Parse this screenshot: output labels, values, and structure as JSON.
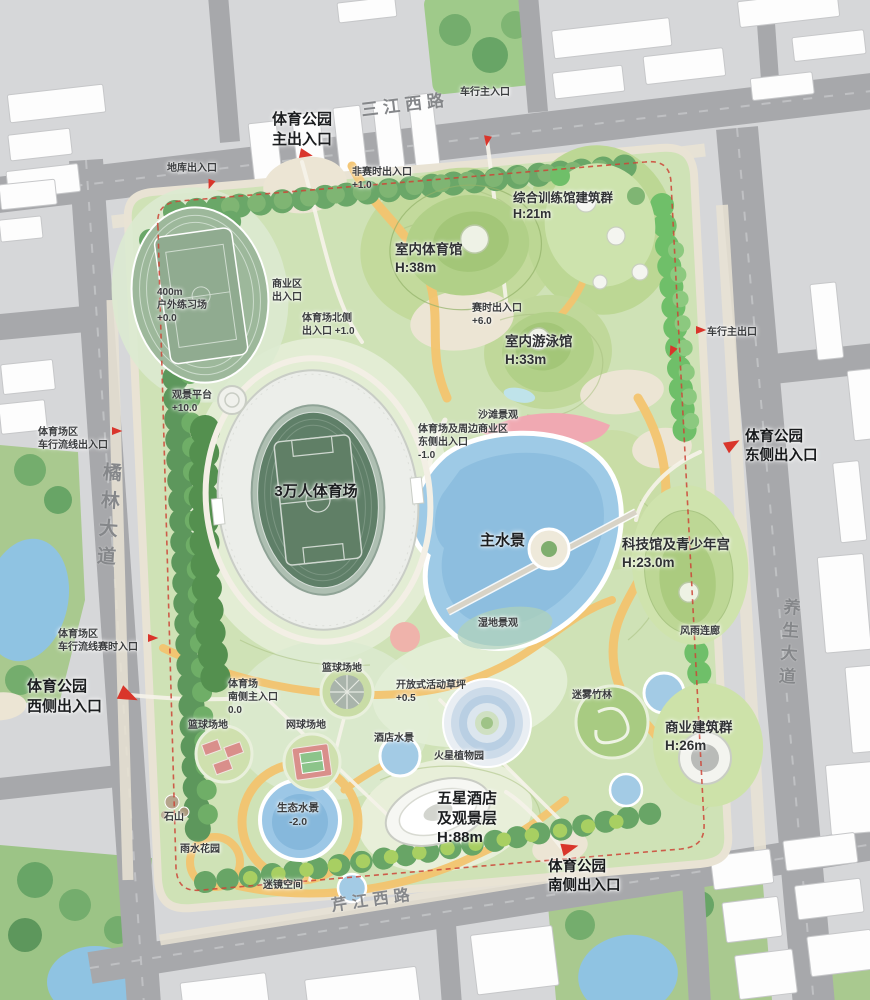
{
  "roads": {
    "top": "三江西路",
    "left": "橘林大道",
    "right": "养生大道",
    "bottom": "芹江西路"
  },
  "gates": {
    "main": "体育公园\n主出入口",
    "east": "体育公园\n东侧出入口",
    "west": "体育公园\n西侧出入口",
    "south": "体育公园\n南侧出入口"
  },
  "vehicle_access": {
    "car_main_in": "车行主入口",
    "car_main_out": "车行主出口",
    "garage": "地库出入口",
    "west_flow": "体育场区\n车行流线出入口",
    "west_flow_event": "体育场区\n车行流线赛时入口"
  },
  "park_entries": {
    "non_event": "非赛时出入口\n+1.0",
    "event": "赛时出入口\n+6.0",
    "business": "商业区\n出入口",
    "stadium_north": "体育场北侧\n出入口 +1.0",
    "stadium_south": "体育场\n南侧主入口\n0.0",
    "stadium_biz_east": "体育场及周边商业区\n东侧出入口\n-1.0"
  },
  "facilities": {
    "training": "综合训练馆建筑群\nH:21m",
    "indoor_gym": "室内体育馆\nH:38m",
    "pool": "室内游泳馆\nH:33m",
    "stadium": "3万人体育场",
    "track400": "400m\n户外练习场\n+0.0",
    "tech": "科技馆及青少年宫\nH:23.0m",
    "commerce": "商业建筑群\nH:26m",
    "hotel": "五星酒店\n及观景层\nH:88m"
  },
  "landscape": {
    "view_platform": "观景平台\n+10.0",
    "beach": "沙滩景观",
    "main_water": "主水景",
    "wetland": "湿地景观",
    "corridor": "风雨连廊",
    "bamboo": "迷雾竹林",
    "lawn": "开放式活动草坪\n+0.5",
    "basketball_upper": "篮球场地",
    "basketball_lower": "篮球场地",
    "tennis": "网球场地",
    "hotel_water": "酒店水景",
    "mars_garden": "火星植物园",
    "rock": "石山",
    "eco_water": "生态水景\n-2.0",
    "rain_garden": "雨水花园",
    "mirror_space": "迷镜空间"
  },
  "icons": {
    "entrance_flag": "red-flag-arrow"
  },
  "colors": {
    "accent_red": "#d23b2f",
    "boundary_red": "#cc4436",
    "path_yellow": "#f3c46f",
    "water_blue": "#9ecae6",
    "beach_pink": "#f0a9b2",
    "park_green": "#cfe2b6",
    "tree_green": "#68a566",
    "road_gray": "#a7a8ab",
    "building_white": "#fdfdfd"
  }
}
